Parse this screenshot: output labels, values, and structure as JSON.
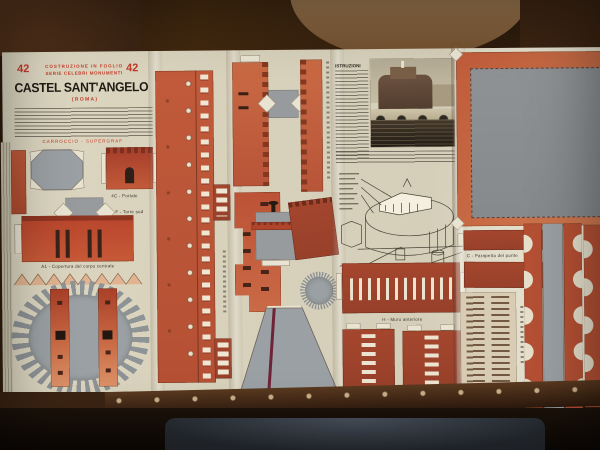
{
  "scene": {
    "subject": "vintage Italian cut-out paper-model sheet on a dark wooden table",
    "colors": {
      "paper": "#ddd7c1",
      "accent_red": "#c23a28",
      "terracotta": "#bf5a3a",
      "brick": "#a5462e",
      "part_gray": "#979b9d",
      "wood_dark": "#33200f",
      "wood_light": "#9b7a52"
    }
  },
  "sheet": {
    "header": {
      "issue_left": "42",
      "issue_right": "42",
      "series_line1": "COSTRUZIONE IN FOGLIO",
      "series_line2": "SERIE  CELEBRI  MONUMENTI",
      "title": "CASTEL SANT'ANGELO",
      "subtitle": "( R O M A )",
      "publisher": "CARROCCIO - SUPERGRAF"
    },
    "instructions_heading": "ISTRUZIONI",
    "captions": {
      "portale": "4C - Portale",
      "torre_sud": "F - Torre sud",
      "copertura_corpo": "A1 - Copertura del corpo centrale",
      "muro_anteriore": "H - Muro anteriore",
      "parapetto_ponte": "C - Parapetto del ponte"
    }
  }
}
